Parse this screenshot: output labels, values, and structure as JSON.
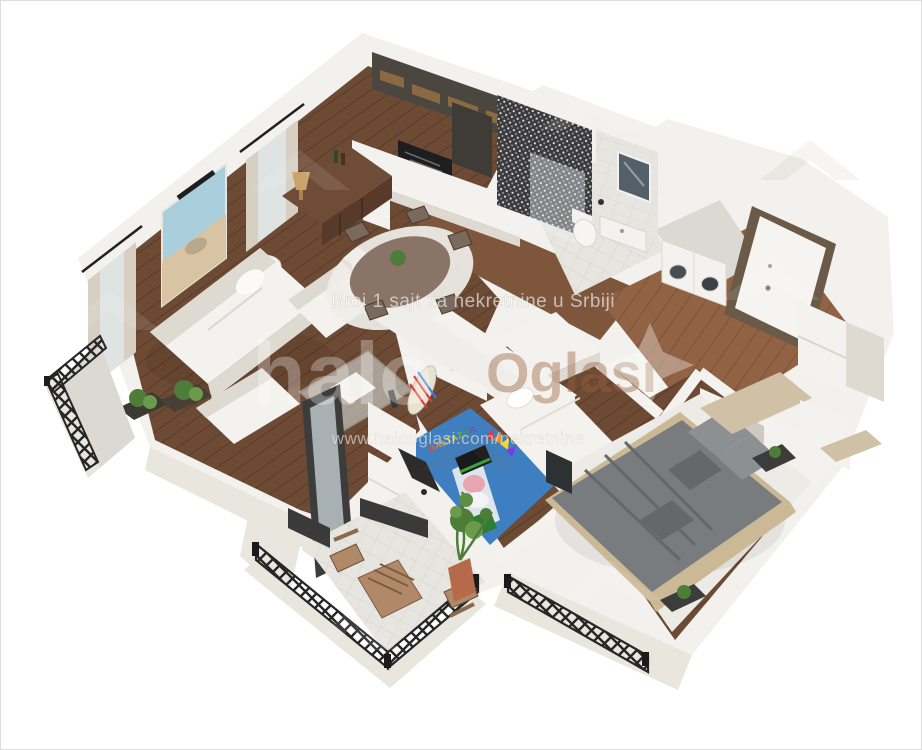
{
  "watermarks": {
    "tagline": "Broj 1 sajt za nekretnine u Srbiji",
    "logo_halo": "halo",
    "logo_oglasi": "Oglasi",
    "url": "www.halooglasi.com/nekretnine",
    "rug_text": "BALTAZAR"
  },
  "colors": {
    "background": "#ffffff",
    "wall_top": "#f2f1ed",
    "wall_face": "#e4e1db",
    "outer_parapet": "#e9e6de",
    "wood_floor": "#6d4a34",
    "wood_floor_light": "#916243",
    "kitchen_cabinet_dark": "#4c4641",
    "counter_black": "#1e1e20",
    "mosaic_tile_dark": "#3a3a3c",
    "furniture_white": "#f4f2ee",
    "sideboard_brown": "#6f4c37",
    "kids_rug_blue": "#3e7fc1",
    "bed_gray": "#797c7f",
    "bed_frame_wood": "#cbb895",
    "railing_black": "#2b2b2b",
    "terracotta_pot": "#b66a4c",
    "plant_green": "#4e7d3a",
    "watermark_white": "rgba(255,255,255,0.6)",
    "watermark_brown": "rgba(150,95,60,0.42)"
  },
  "scene": {
    "description": "3D isometric render of a two-bedroom apartment floor plan with balconies",
    "rooms": [
      {
        "name": "living-dining-room",
        "items": [
          "white sofa",
          "white armchair",
          "white chaise",
          "glass coffee table",
          "floor lamp",
          "wooden sideboard",
          "table lamp",
          "beach painting",
          "curtained windows",
          "round dining table",
          "dining chairs",
          "round rug",
          "indoor planters"
        ]
      },
      {
        "name": "kitchen",
        "items": [
          "dark upper cabinets",
          "extractor hood",
          "black cooktop counter",
          "white lower cabinets",
          "fridge"
        ]
      },
      {
        "name": "bathroom",
        "items": [
          "mosaic shower wall",
          "glass shower screen",
          "mirror",
          "toilet",
          "vanity sink"
        ]
      },
      {
        "name": "laundry-room",
        "items": [
          "washing machine",
          "dryer"
        ]
      },
      {
        "name": "hallway",
        "items": [
          "entrance door",
          "white wardrobes",
          "open shelving"
        ]
      },
      {
        "name": "kids-room",
        "items": [
          "white bed",
          "desk",
          "office chair",
          "blue cartoon rug",
          "surfboard art",
          "white dresser",
          "potted plant"
        ]
      },
      {
        "name": "master-bedroom",
        "items": [
          "gray double bed",
          "wooden headboard",
          "pillows",
          "nightstands",
          "wall tv",
          "beige wardrobe",
          "white rug",
          "potted plant"
        ]
      },
      {
        "name": "left-balcony",
        "items": [
          "black lattice railing",
          "planters"
        ]
      },
      {
        "name": "terrace",
        "items": [
          "black lattice railing",
          "wooden bistro table",
          "folding chairs",
          "terracotta planter"
        ]
      },
      {
        "name": "juliet-balcony",
        "items": [
          "black lattice railing"
        ]
      }
    ]
  }
}
